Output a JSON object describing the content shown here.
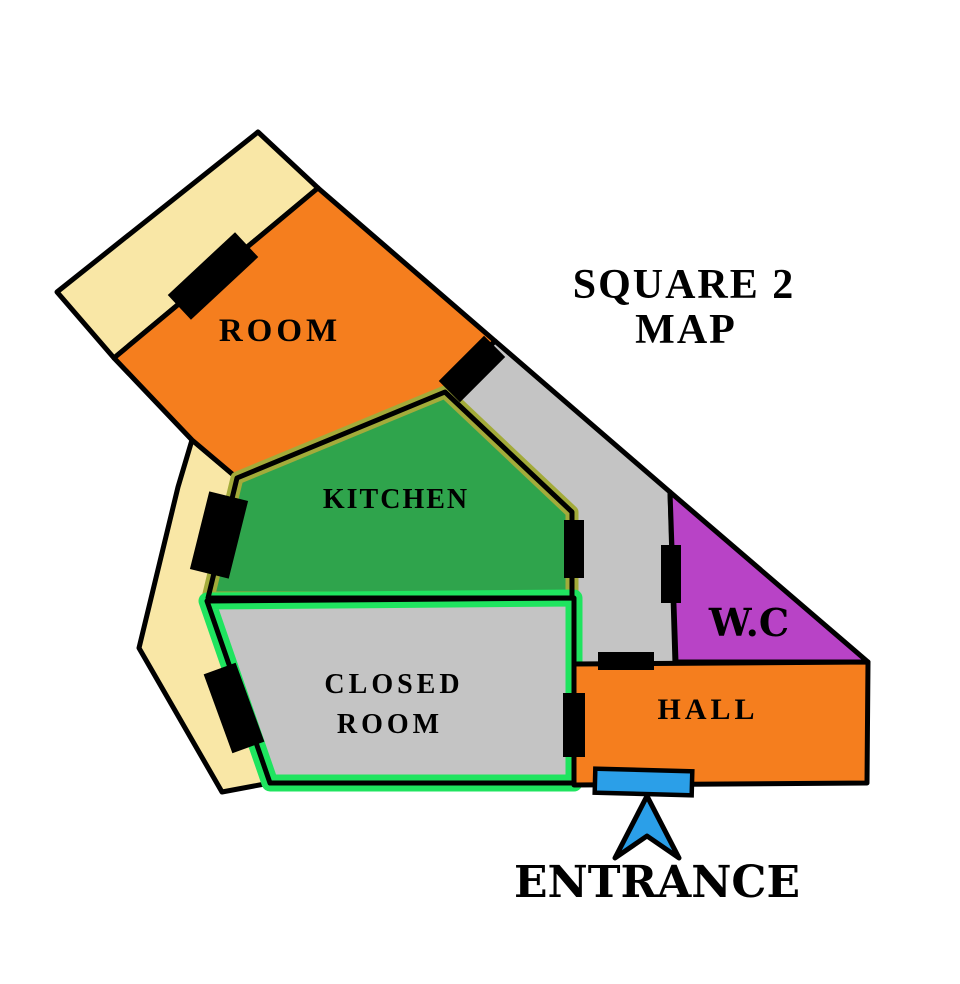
{
  "title": {
    "line1": "SQUARE 2",
    "line2": "MAP"
  },
  "colors": {
    "background": "#ffffff",
    "wall": "#000000",
    "orange": "#F57E1E",
    "beige": "#F9E7A6",
    "kitchen_green": "#2FA44C",
    "kitchen_border_olive": "#A3AB3A",
    "gray": "#C4C4C4",
    "closed_border_green": "#1FE45F",
    "purple": "#B843C6",
    "blue": "#2B9FE8"
  },
  "rooms": {
    "room": {
      "label": "ROOM"
    },
    "kitchen": {
      "label": "KITCHEN"
    },
    "closed_room": {
      "label_line1": "CLOSED",
      "label_line2": "ROOM"
    },
    "wc": {
      "label": "W.C"
    },
    "hall": {
      "label": "HALL"
    }
  },
  "entrance": {
    "label": "ENTRANCE"
  },
  "icons": {
    "entrance_arrow": "arrow-up-icon"
  }
}
